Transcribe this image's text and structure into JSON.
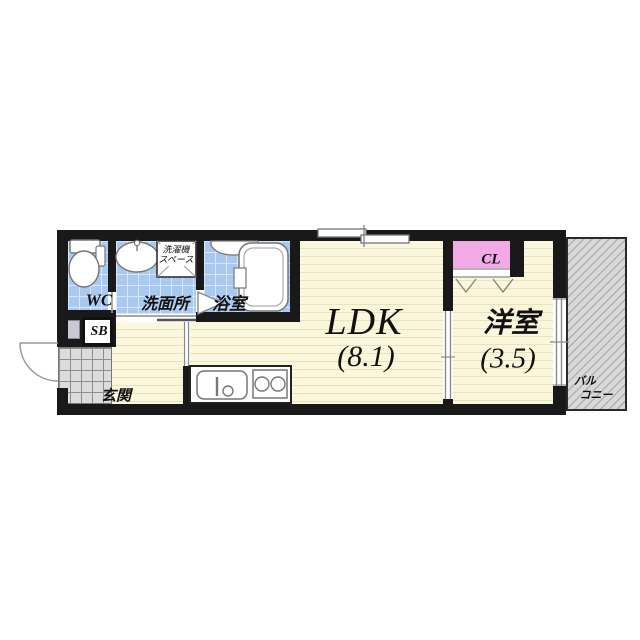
{
  "plan_type": "1LDK apartment floor plan",
  "rooms": {
    "wc": {
      "label": "WC"
    },
    "washroom": {
      "label": "洗面所"
    },
    "laundry_space": {
      "line1": "洗濯機",
      "line2": "スペース"
    },
    "bath": {
      "label": "浴室"
    },
    "ldk": {
      "label": "LDK",
      "size": "(8.1)"
    },
    "western_room": {
      "label": "洋室",
      "size": "(3.5)"
    },
    "closet": {
      "label": "CL"
    },
    "shoe_box": {
      "label": "SB"
    },
    "entrance": {
      "label": "玄関"
    },
    "balcony": {
      "line1": "バル",
      "line2": "コニー"
    }
  },
  "colors": {
    "wall": "#191919",
    "floor_cream": "#fbf7dc",
    "floor_stripe": "#e9e2bf",
    "tile_blue": "#a9c9f0",
    "tile_blue_line": "#d8e5fa",
    "closet_pink": "#f2aae6",
    "entrance_tile": "#dcdcdc",
    "balcony_gray": "#d9d9d9",
    "balcony_hatch": "#b2b2b2",
    "fixture_line": "#7a7a7a"
  }
}
